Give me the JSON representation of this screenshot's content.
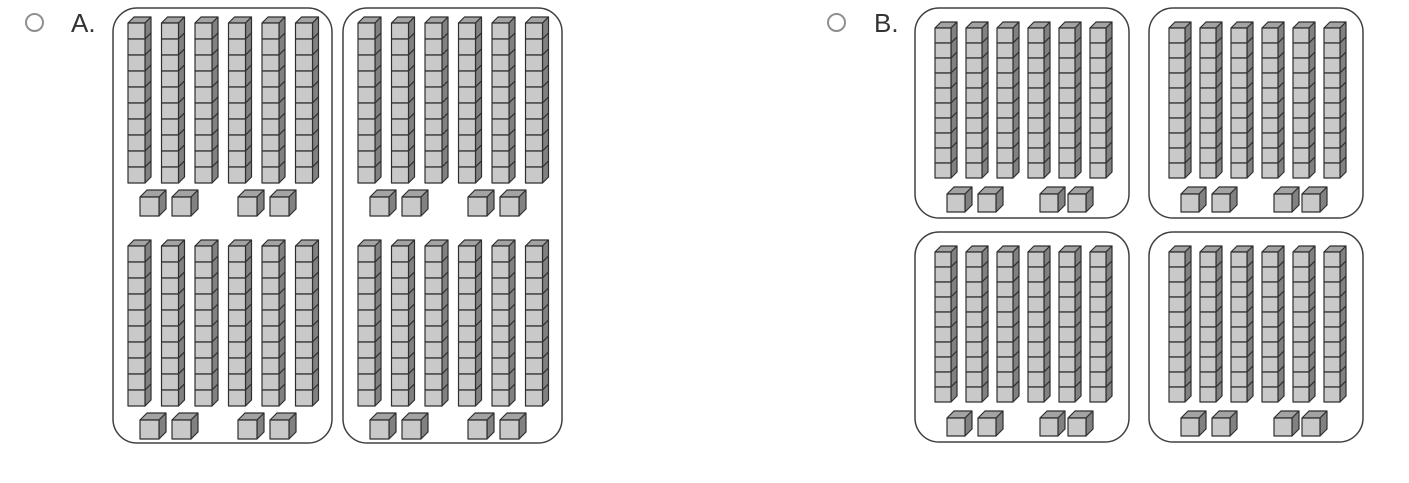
{
  "answer_options": [
    {
      "id": "A",
      "label": "A.",
      "selected": false,
      "container_count": 2,
      "containers": [
        {
          "groups": 2
        },
        {
          "groups": 2
        }
      ],
      "blocks_shown": {
        "tens_rods": 24,
        "unit_cubes": 16
      }
    },
    {
      "id": "B",
      "label": "B.",
      "selected": false,
      "container_count": 4,
      "containers": [
        {
          "groups": 1
        },
        {
          "groups": 1
        },
        {
          "groups": 1
        },
        {
          "groups": 1
        }
      ],
      "blocks_shown": {
        "tens_rods": 24,
        "unit_cubes": 16
      }
    }
  ],
  "group_composition": {
    "rods_per_group": 6,
    "cubes_per_rod": 10,
    "unit_cubes_per_group": 4,
    "unit_cube_arrangement": "2 + 2"
  },
  "colors": {
    "cube_front": "#c9c9c9",
    "cube_top": "#a3a3a3",
    "cube_side": "#818181",
    "cube_outline": "#2f2f2f",
    "container_border": "#404040",
    "radio_border": "#8f8f8f",
    "label_text": "#333333",
    "background": "#ffffff"
  }
}
